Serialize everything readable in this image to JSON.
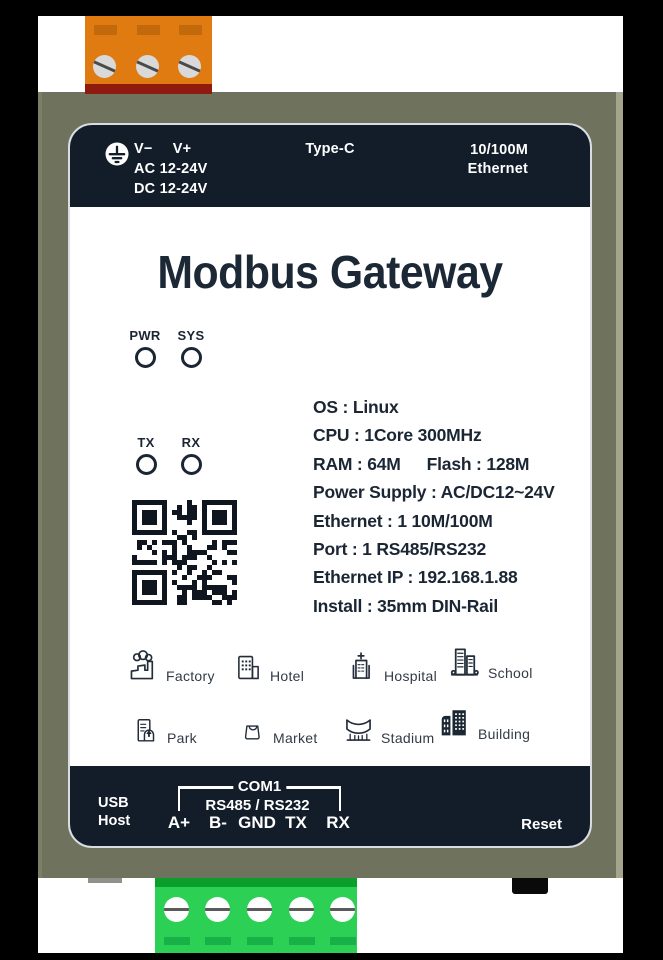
{
  "product": {
    "title": "Modbus Gateway"
  },
  "top_panel": {
    "ground_icon": "protective-earth-icon",
    "v_minus": "V−",
    "v_plus": "V+",
    "ac_rating": "AC 12-24V",
    "dc_rating": "DC 12-24V",
    "usb_port_label": "Type-C",
    "ethernet_label_line1": "10/100M",
    "ethernet_label_line2": "Ethernet"
  },
  "leds": {
    "pwr": "PWR",
    "sys": "SYS",
    "tx": "TX",
    "rx": "RX"
  },
  "specs": {
    "os": "OS : Linux",
    "cpu": "CPU : 1Core 300MHz",
    "ram": "RAM : 64M",
    "flash": "Flash : 128M",
    "power": "Power Supply : AC/DC12~24V",
    "ethernet": "Ethernet : 1 10M/100M",
    "port": "Port : 1 RS485/RS232",
    "ip": "Ethernet IP : 192.168.1.88",
    "install": "Install : 35mm DIN-Rail"
  },
  "applications": [
    {
      "icon": "factory-icon",
      "label": "Factory"
    },
    {
      "icon": "hotel-icon",
      "label": "Hotel"
    },
    {
      "icon": "hospital-icon",
      "label": "Hospital"
    },
    {
      "icon": "school-icon",
      "label": "School"
    },
    {
      "icon": "park-icon",
      "label": "Park"
    },
    {
      "icon": "market-icon",
      "label": "Market"
    },
    {
      "icon": "stadium-icon",
      "label": "Stadium"
    },
    {
      "icon": "building-icon",
      "label": "Building"
    }
  ],
  "bottom_panel": {
    "usb_line1": "USB",
    "usb_line2": "Host",
    "com_label": "COM1",
    "serial_label": "RS485 / RS232",
    "terminals": [
      "A+",
      "B-",
      "GND",
      "TX",
      "RX"
    ],
    "reset_label": "Reset"
  },
  "colors": {
    "panel_navy": "#131d2a",
    "body_olive": "#6f725c",
    "terminal_orange": "#df7b11",
    "terminal_orange_base": "#8e1a10",
    "terminal_green": "#2bd055",
    "terminal_green_cap": "#0a9e2b",
    "text_navy": "#1c2836",
    "label_background": "#ffffff"
  }
}
